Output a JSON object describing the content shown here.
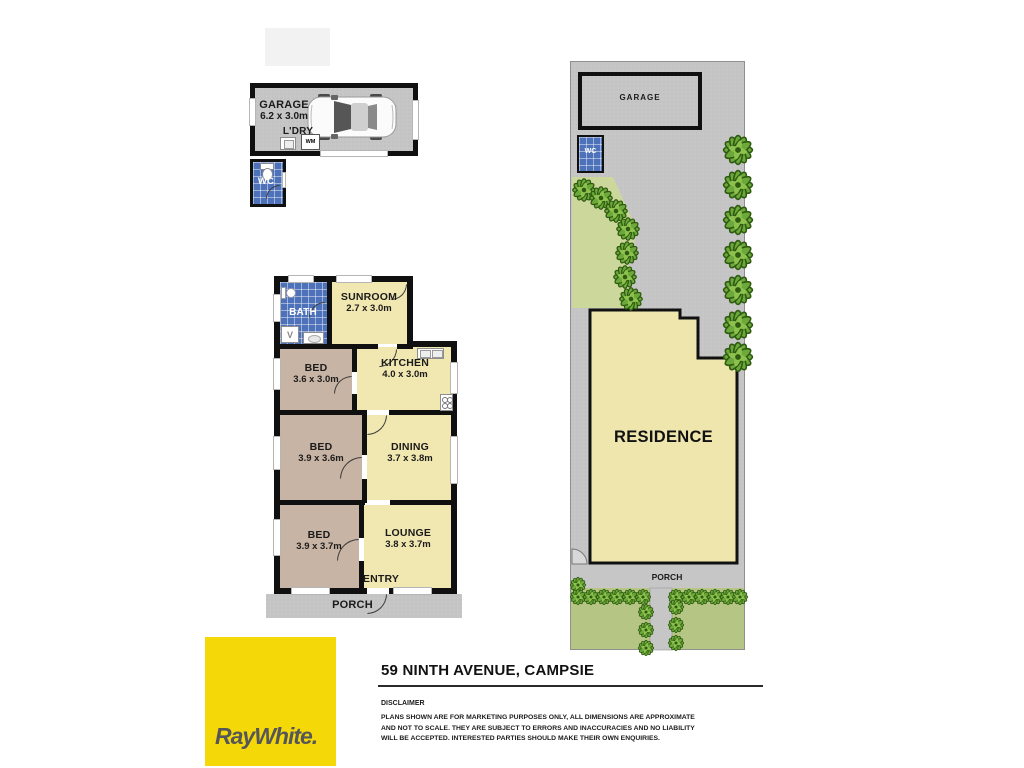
{
  "garage_plan": {
    "title": "GARAGE",
    "dims": "6.2 x 3.0m",
    "laundry_label": "L'DRY",
    "washing_machine_label": "WM",
    "wc_label": "WC"
  },
  "floor_plan": {
    "bath": {
      "name": "BATH"
    },
    "sunroom": {
      "name": "SUNROOM",
      "dims": "2.7 x 3.0m"
    },
    "bed1": {
      "name": "BED",
      "dims": "3.6 x 3.0m"
    },
    "kitchen": {
      "name": "KITCHEN",
      "dims": "4.0 x 3.0m"
    },
    "bed2": {
      "name": "BED",
      "dims": "3.9 x 3.6m"
    },
    "dining": {
      "name": "DINING",
      "dims": "3.7 x 3.8m"
    },
    "bed3": {
      "name": "BED",
      "dims": "3.9 x 3.7m"
    },
    "lounge": {
      "name": "LOUNGE",
      "dims": "3.8 x 3.7m"
    },
    "entry_label": "ENTRY",
    "porch_label": "PORCH"
  },
  "site_plan": {
    "garage_label": "GARAGE",
    "wc_label": "WC",
    "residence_label": "RESIDENCE",
    "porch_label": "PORCH"
  },
  "footer": {
    "brand": "RayWhite.",
    "address": "59 NINTH AVENUE, CAMPSIE",
    "disclaimer_heading": "DISCLAIMER",
    "disclaimer_body": "PLANS SHOWN ARE FOR MARKETING PURPOSES ONLY, ALL DIMENSIONS ARE APPROXIMATE AND NOT TO SCALE. THEY ARE SUBJECT TO ERRORS AND INACCURACIES AND NO LIABILITY WILL BE ACCEPTED. INTERESTED PARTIES SHOULD MAKE THEIR OWN ENQUIRIES."
  },
  "colors": {
    "wall": "#101010",
    "room_yellow": "#f1e7b0",
    "bedroom_tan": "#c8b4a4",
    "tile_blue": "#4e72b9",
    "lot_gray": "#c6c6c6",
    "lawn_green": "#b5c584",
    "garden_green": "#ccd79b",
    "shrub_green": "#6da93a",
    "brand_yellow": "#f5d807",
    "brand_text": "#55565a"
  }
}
